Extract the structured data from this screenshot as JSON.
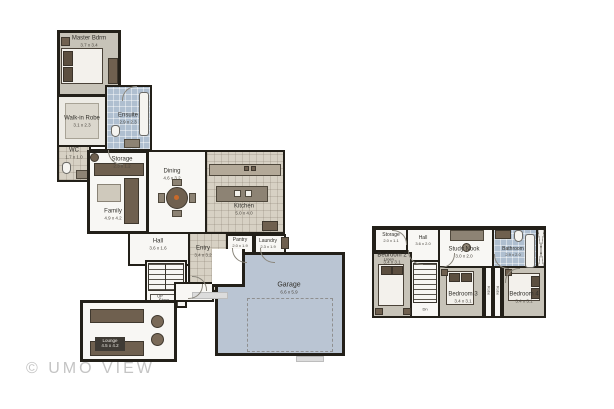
{
  "watermark": "© UMO VIEW",
  "colors": {
    "wall": "#232019",
    "room_gray": "#c7c3b8",
    "room_white": "#f8f7f4",
    "tile_blue": "#afbfd0",
    "tile_beige": "#d7d1c4",
    "garage_fill": "#bac5d3",
    "furniture_dark": "#6f604f",
    "accent_orange": "#c96a2a",
    "watermark_gray": "#c4c4c4"
  },
  "plans": {
    "main": {
      "rooms": {
        "master": {
          "name": "Master Bdrm",
          "dims": "3.7 x 3.4"
        },
        "robe": {
          "name": "Walk-in Robe",
          "dims": "3.1 x 2.3"
        },
        "ensuite": {
          "name": "Ensuite",
          "dims": "2.9 x 2.3"
        },
        "wc": {
          "name": "WC",
          "dims": "1.7 x 1.0"
        },
        "storage": {
          "name": "Storage",
          "dims": "2.3 x 1.2"
        },
        "family": {
          "name": "Family",
          "dims": "4.9 x 4.2"
        },
        "dining": {
          "name": "Dining",
          "dims": "4.6 x 3.2"
        },
        "kitchen": {
          "name": "Kitchen",
          "dims": "5.0 x 4.0"
        },
        "hall": {
          "name": "Hall",
          "dims": "3.6 x 1.6"
        },
        "entry": {
          "name": "Entry",
          "dims": "3.4 x 3.2"
        },
        "pantry": {
          "name": "Pantry",
          "dims": "2.0 x 1.9"
        },
        "laundry": {
          "name": "Laundry",
          "dims": "2.3 x 1.9"
        },
        "garage": {
          "name": "Garage",
          "dims": "6.6 x 5.9"
        },
        "lounge": {
          "name": "Lounge",
          "dims": "4.5 x 4.2"
        },
        "stairs_up": "UP",
        "store": "Store"
      }
    },
    "upper": {
      "rooms": {
        "storage": {
          "name": "Storage",
          "dims": "2.0 x 1.1"
        },
        "linen": {
          "name": "Linen"
        },
        "hall": {
          "name": "Hall",
          "dims": "3.6 x 2.0"
        },
        "study": {
          "name": "Study Nook",
          "dims": "3.0 x 2.0"
        },
        "bathroom": {
          "name": "Bathroom",
          "dims": "2.9 x 2.0"
        },
        "bedroom2": {
          "name": "Bedroom 2",
          "dims": "3.4 x 3.1"
        },
        "bedroom3": {
          "name": "Bedroom 3",
          "dims": "3.4 x 3.1"
        },
        "bedroom4": {
          "name": "Bedroom 4",
          "dims": "3.4 x 3.1"
        },
        "stairs_dn": "Dn",
        "robe": "Robe"
      }
    }
  }
}
